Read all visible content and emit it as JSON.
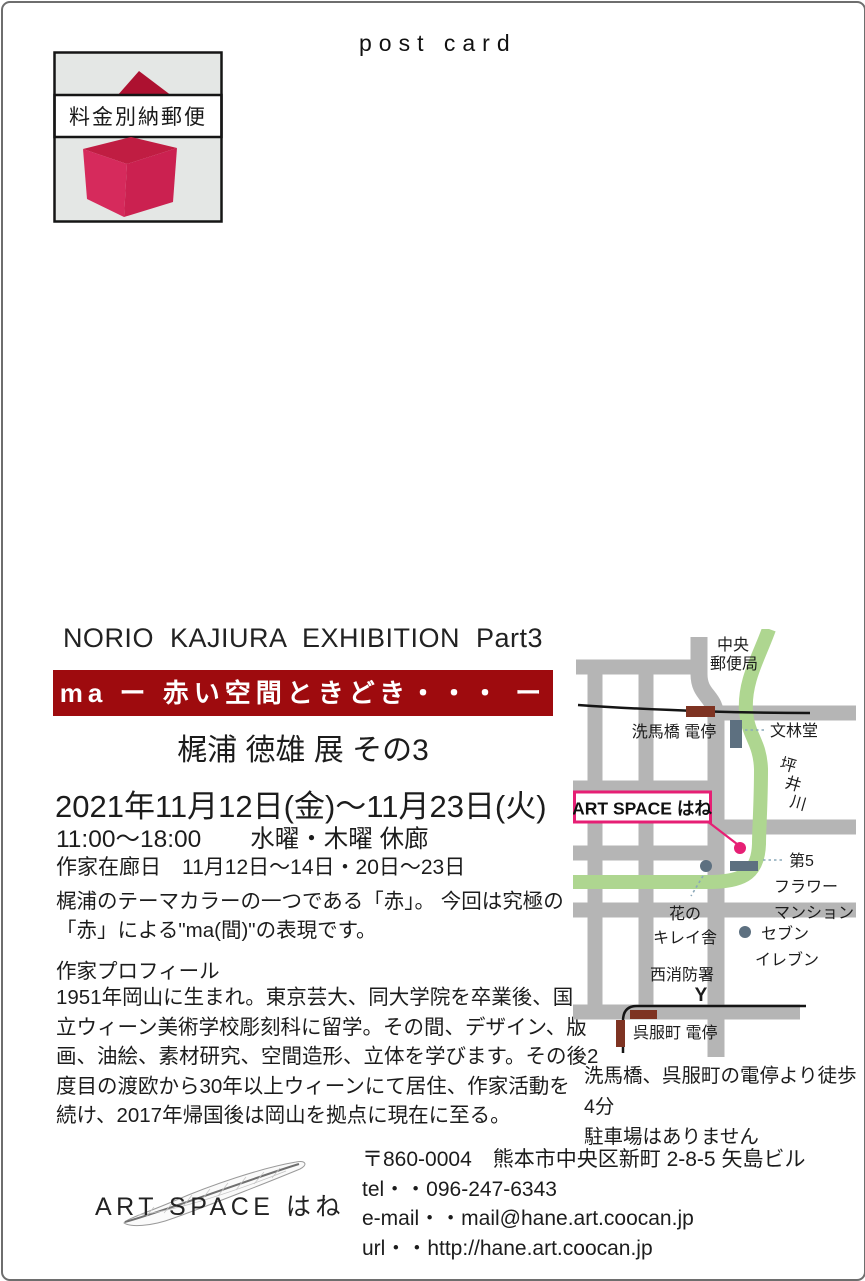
{
  "postcard": {
    "post_card_label": "post card",
    "stamp": {
      "label": "料金別納郵便"
    },
    "exhibition": {
      "title_en": "NORIO  KAJIURA  EXHIBITION  Part3",
      "banner": "ma ー 赤い空間ときどき・・・ ー",
      "banner_color": "#9e0b0e",
      "title_jp": "梶浦 徳雄 展 その3",
      "dates": "2021年11月12日(金)～11月23日(火)",
      "hours": "11:00～18:00　　水曜・木曜 休廊",
      "artist_days": "作家在廊日　11月12日～14日・20日～23日",
      "description": [
        "梶浦のテーマカラーの一つである「赤」。 今回は究極の",
        "「赤」による\"ma(間)\"の表現です。"
      ],
      "profile_heading": "作家プロフィール",
      "profile": [
        "1951年岡山に生まれ。東京芸大、同大学院を卒業後、国",
        "立ウィーン美術学校彫刻科に留学。その間、デザイン、版",
        "画、油絵、素材研究、空間造形、立体を学びます。その後2",
        "度目の渡欧から30年以上ウィーンにて居住、作家活動を",
        "続け、2017年帰国後は岡山を拠点に現在に至る。"
      ]
    },
    "map": {
      "labels": {
        "post_office": [
          "中央",
          "郵便局"
        ],
        "semba_stop": "洗馬橋 電停",
        "bunrindo": "文林堂",
        "tsuboi_river": [
          "坪",
          "井",
          "川"
        ],
        "art_space": "ART SPACE はね",
        "mansion": [
          "第5",
          "フラワー",
          "マンション"
        ],
        "hanano": [
          "花の",
          "キレイ舎"
        ],
        "seven_eleven": [
          "セブン",
          "イレブン"
        ],
        "fire_station": "西消防署",
        "fire_symbol": "Y",
        "gofukumachi_stop": "呉服町 電停"
      },
      "notes": [
        "洗馬橋、呉服町の電停より徒歩4分",
        "駐車場はありません"
      ],
      "colors": {
        "road": "#b5b5b5",
        "river": "#aed690",
        "rail": "#151515",
        "tram_stop": "#7e3322",
        "building": "#5d7080",
        "accent_pink": "#e61f74"
      }
    },
    "footer": {
      "logo_text": "ART SPACE はね",
      "address": "〒860-0004　熊本市中央区新町 2-8-5 矢島ビル",
      "tel": "tel・・096-247-6343",
      "email": "e-mail・・mail@hane.art.coocan.jp",
      "url": "url・・http://hane.art.coocan.jp"
    }
  }
}
